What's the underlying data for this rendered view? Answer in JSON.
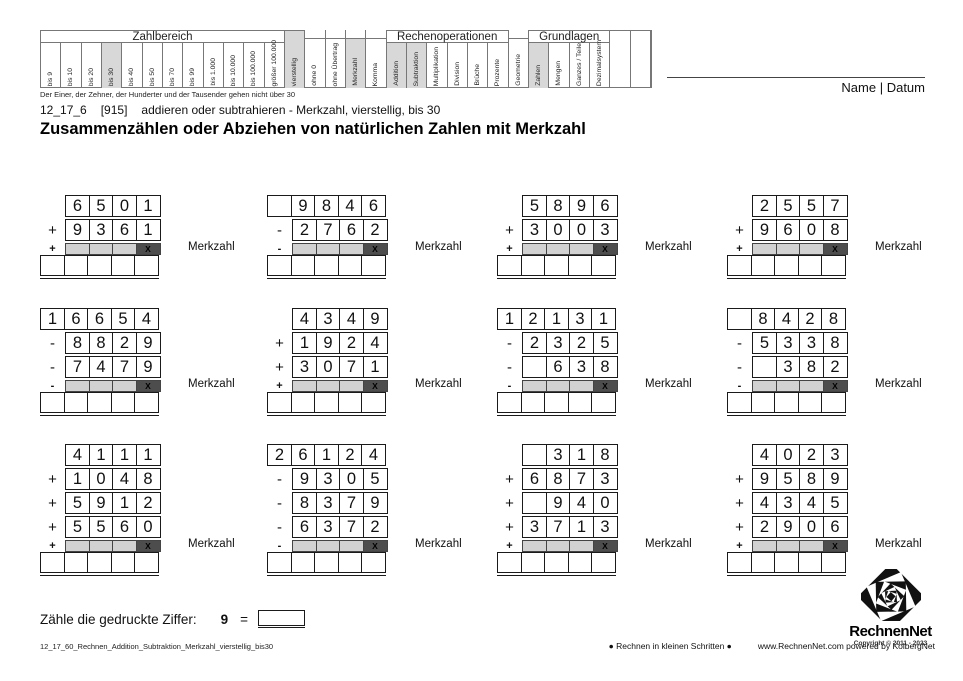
{
  "name_datum": "Name | Datum",
  "subtitle": {
    "code": "12_17_6",
    "id": "[915]",
    "desc": "addieren oder subtrahieren - Merkzahl, vierstellig, bis 30"
  },
  "title": "Zusammenzählen oder Abziehen von natürlichen Zahlen mit Merkzahl",
  "merkzahl_label": "Merkzahl",
  "merk_x": "X",
  "colors": {
    "highlight": "#d8d8d8",
    "merk_gray": "#d2d2d2",
    "merk_dark": "#4d4d4d",
    "accent_black": "#111111"
  },
  "header_table": {
    "note": "Der Einer, der Zehner, der Hunderter und der Tausender gehen nicht über 30",
    "segments": [
      {
        "kind": "group",
        "title": "Zahlbereich",
        "cols": [
          {
            "label": "bis 9"
          },
          {
            "label": "bis 10"
          },
          {
            "label": "bis 20"
          },
          {
            "label": "bis 30",
            "hl": true
          },
          {
            "label": "bis 40"
          },
          {
            "label": "bis 50"
          },
          {
            "label": "bis 70"
          },
          {
            "label": "bis 99"
          },
          {
            "label": "bis 1.000"
          },
          {
            "label": "bis 10.000"
          },
          {
            "label": "bis 100.000"
          },
          {
            "label": "größer 100.000"
          }
        ]
      },
      {
        "kind": "single",
        "cols": [
          {
            "label": "vierstellig",
            "hl": true,
            "full": true
          },
          {
            "label": "ohne 0"
          },
          {
            "label": "ohne Übertrag"
          },
          {
            "label": "Merkzahl",
            "hl": true
          },
          {
            "label": "Komma"
          }
        ]
      },
      {
        "kind": "group",
        "title": "Rechenoperationen",
        "cols": [
          {
            "label": "Addition",
            "hl": true
          },
          {
            "label": "Subtraktion",
            "hl": true
          },
          {
            "label": "Multiplikation"
          },
          {
            "label": "Division"
          },
          {
            "label": "Brüche"
          },
          {
            "label": "Prozente"
          }
        ]
      },
      {
        "kind": "single",
        "cols": [
          {
            "label": "Geometrie"
          }
        ]
      },
      {
        "kind": "group",
        "title": "Grundlagen",
        "cols": [
          {
            "label": "Zahlen",
            "hl": true
          },
          {
            "label": "Mengen"
          },
          {
            "label": "Ganzes / Teile"
          },
          {
            "label": "Dezimalsystem"
          }
        ]
      },
      {
        "kind": "single",
        "cols": [
          {
            "label": "",
            "full": true
          },
          {
            "label": "",
            "full": true
          }
        ]
      }
    ]
  },
  "problems": [
    {
      "merk_sign": "+",
      "rows": [
        {
          "sign": "",
          "cells": [
            "6",
            "5",
            "0",
            "1"
          ]
        },
        {
          "sign": "+",
          "cells": [
            "9",
            "3",
            "6",
            "1"
          ]
        }
      ]
    },
    {
      "merk_sign": "-",
      "rows": [
        {
          "sign": "",
          "cells": [
            "",
            "9",
            "8",
            "4",
            "6"
          ]
        },
        {
          "sign": "-",
          "cells": [
            "2",
            "7",
            "6",
            "2"
          ]
        }
      ]
    },
    {
      "merk_sign": "+",
      "rows": [
        {
          "sign": "",
          "cells": [
            "5",
            "8",
            "9",
            "6"
          ]
        },
        {
          "sign": "+",
          "cells": [
            "3",
            "0",
            "0",
            "3"
          ]
        }
      ]
    },
    {
      "merk_sign": "+",
      "rows": [
        {
          "sign": "",
          "cells": [
            "2",
            "5",
            "5",
            "7"
          ]
        },
        {
          "sign": "+",
          "cells": [
            "9",
            "6",
            "0",
            "8"
          ]
        }
      ]
    },
    {
      "merk_sign": "-",
      "rows": [
        {
          "sign": "",
          "cells": [
            "1",
            "6",
            "6",
            "5",
            "4"
          ]
        },
        {
          "sign": "-",
          "cells": [
            "8",
            "8",
            "2",
            "9"
          ]
        },
        {
          "sign": "-",
          "cells": [
            "7",
            "4",
            "7",
            "9"
          ]
        }
      ]
    },
    {
      "merk_sign": "+",
      "rows": [
        {
          "sign": "",
          "cells": [
            "4",
            "3",
            "4",
            "9"
          ]
        },
        {
          "sign": "+",
          "cells": [
            "1",
            "9",
            "2",
            "4"
          ]
        },
        {
          "sign": "+",
          "cells": [
            "3",
            "0",
            "7",
            "1"
          ]
        }
      ]
    },
    {
      "merk_sign": "-",
      "rows": [
        {
          "sign": "",
          "cells": [
            "1",
            "2",
            "1",
            "3",
            "1"
          ]
        },
        {
          "sign": "-",
          "cells": [
            "2",
            "3",
            "2",
            "5"
          ]
        },
        {
          "sign": "-",
          "cells": [
            "",
            "6",
            "3",
            "8"
          ]
        }
      ]
    },
    {
      "merk_sign": "-",
      "rows": [
        {
          "sign": "",
          "cells": [
            "",
            "8",
            "4",
            "2",
            "8"
          ]
        },
        {
          "sign": "-",
          "cells": [
            "5",
            "3",
            "3",
            "8"
          ]
        },
        {
          "sign": "-",
          "cells": [
            "",
            "3",
            "8",
            "2"
          ]
        }
      ]
    },
    {
      "merk_sign": "+",
      "rows": [
        {
          "sign": "",
          "cells": [
            "4",
            "1",
            "1",
            "1"
          ]
        },
        {
          "sign": "+",
          "cells": [
            "1",
            "0",
            "4",
            "8"
          ]
        },
        {
          "sign": "+",
          "cells": [
            "5",
            "9",
            "1",
            "2"
          ]
        },
        {
          "sign": "+",
          "cells": [
            "5",
            "5",
            "6",
            "0"
          ]
        }
      ]
    },
    {
      "merk_sign": "-",
      "rows": [
        {
          "sign": "",
          "cells": [
            "2",
            "6",
            "1",
            "2",
            "4"
          ]
        },
        {
          "sign": "-",
          "cells": [
            "9",
            "3",
            "0",
            "5"
          ]
        },
        {
          "sign": "-",
          "cells": [
            "8",
            "3",
            "7",
            "9"
          ]
        },
        {
          "sign": "-",
          "cells": [
            "6",
            "3",
            "7",
            "2"
          ]
        }
      ]
    },
    {
      "merk_sign": "+",
      "rows": [
        {
          "sign": "",
          "cells": [
            "",
            "3",
            "1",
            "8"
          ]
        },
        {
          "sign": "+",
          "cells": [
            "6",
            "8",
            "7",
            "3"
          ]
        },
        {
          "sign": "+",
          "cells": [
            "",
            "9",
            "4",
            "0"
          ]
        },
        {
          "sign": "+",
          "cells": [
            "3",
            "7",
            "1",
            "3"
          ]
        }
      ]
    },
    {
      "merk_sign": "+",
      "rows": [
        {
          "sign": "",
          "cells": [
            "4",
            "0",
            "2",
            "3"
          ]
        },
        {
          "sign": "+",
          "cells": [
            "9",
            "5",
            "8",
            "9"
          ]
        },
        {
          "sign": "+",
          "cells": [
            "4",
            "3",
            "4",
            "5"
          ]
        },
        {
          "sign": "+",
          "cells": [
            "2",
            "9",
            "0",
            "6"
          ]
        }
      ]
    }
  ],
  "task": {
    "text": "Zähle die gedruckte Ziffer:",
    "digit": "9",
    "equals": "="
  },
  "footer": {
    "filename": "12_17_60_Rechnen_Addition_Subtraktion_Merkzahl_vierstellig_bis30",
    "slogan": "● Rechnen in kleinen Schritten ●",
    "site": "www.RechnenNet.com powered by KolbergNet"
  },
  "logo": {
    "name": "RechnenNet",
    "copyright": "Copyright © 2011 - 2023"
  }
}
